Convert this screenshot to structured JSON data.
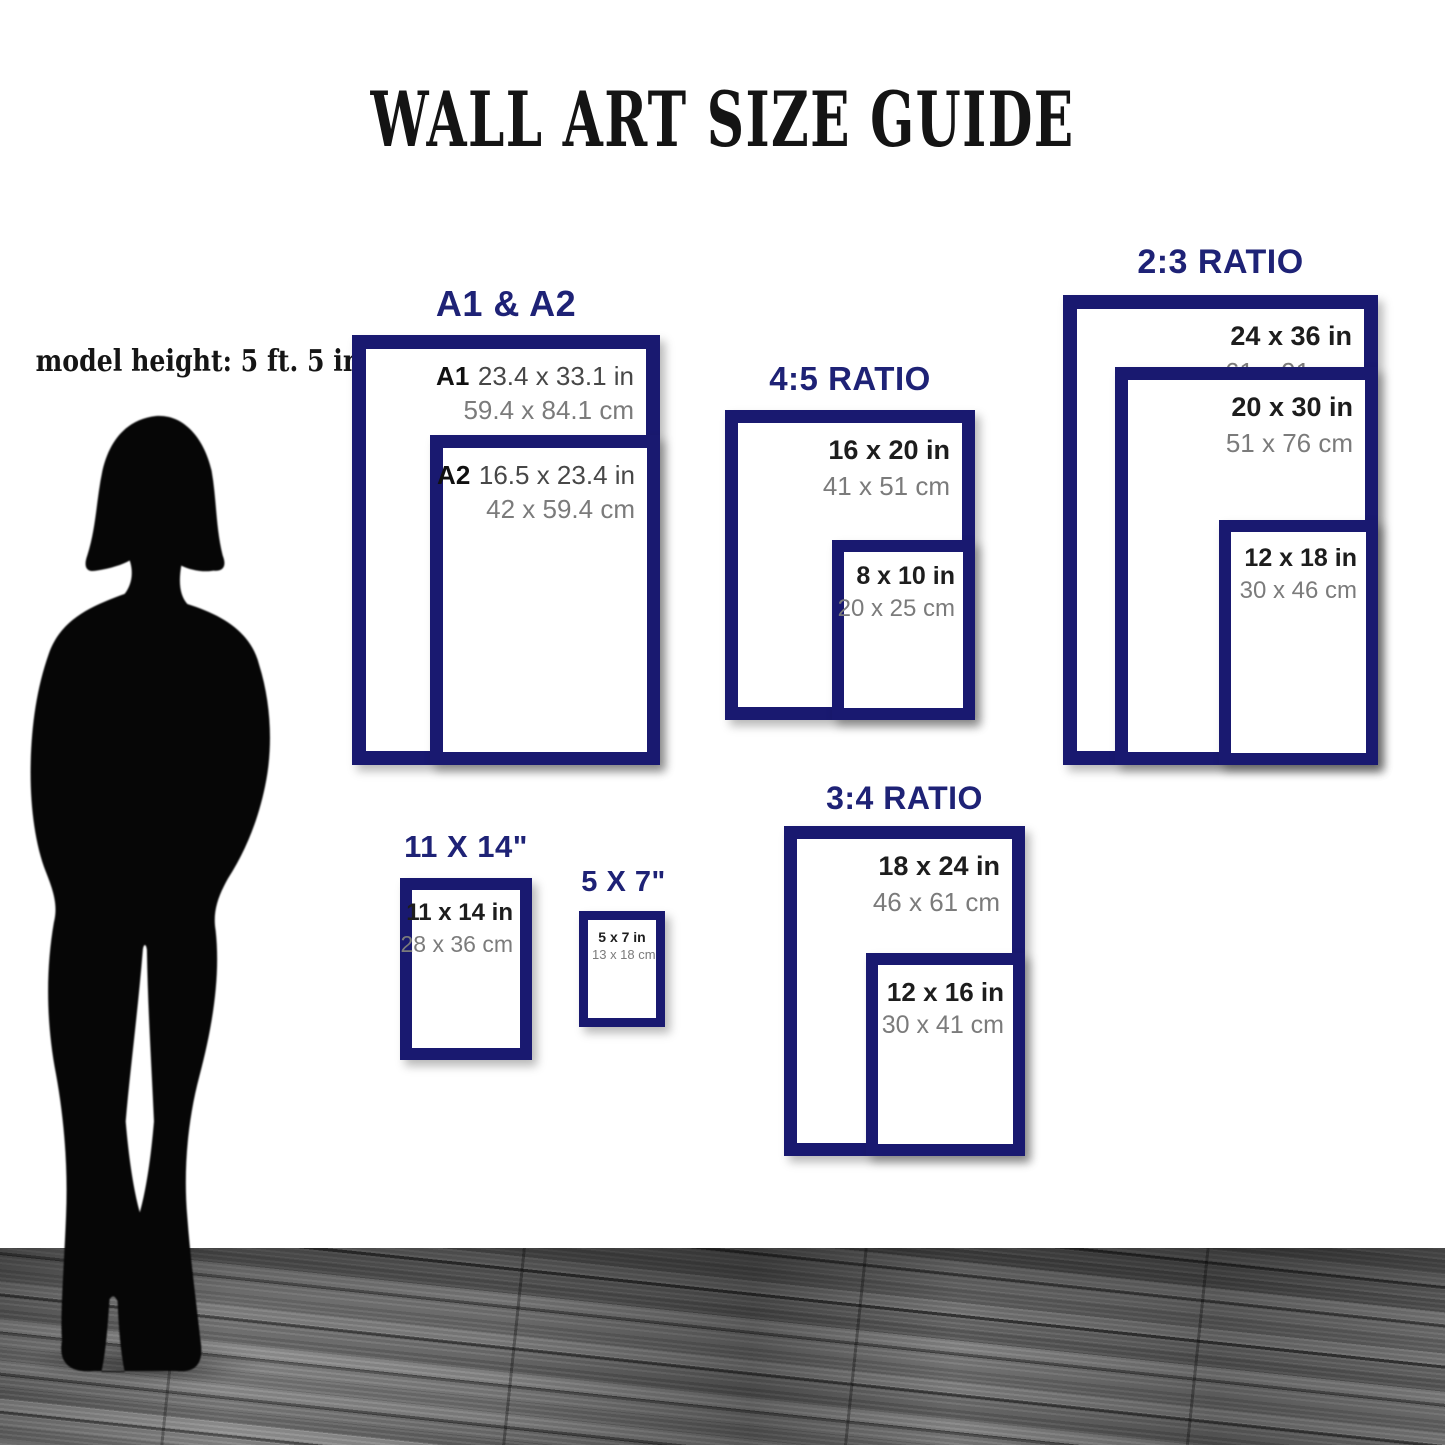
{
  "page": {
    "title": "WALL ART SIZE GUIDE",
    "model_height_label": "model height: 5 ft. 5 in"
  },
  "colors": {
    "frame_border_navy": "#191970",
    "header_navy": "#1e2276",
    "inches_text": "#1d1d1d",
    "cm_text": "#7b7b7b",
    "silhouette": "#060606",
    "background": "#ffffff"
  },
  "decor": {
    "figure": "woman-silhouette",
    "floor": "wood-floor"
  },
  "sections": [
    {
      "header": "A1 & A2",
      "frames": [
        {
          "prefix": "A1",
          "size_in": "23.4 x 33.1 in",
          "size_cm": "59.4 x 84.1 cm"
        },
        {
          "prefix": "A2",
          "size_in": "16.5 x 23.4 in",
          "size_cm": "42 x 59.4 cm"
        }
      ]
    },
    {
      "header": "4:5 RATIO",
      "frames": [
        {
          "size_in": "16 x 20 in",
          "size_cm": "41 x 51 cm"
        },
        {
          "size_in": "8 x 10 in",
          "size_cm": "20 x 25 cm"
        }
      ]
    },
    {
      "header": "2:3 RATIO",
      "frames": [
        {
          "size_in": "24 x 36 in",
          "size_cm": "61 x 91 cm"
        },
        {
          "size_in": "20 x 30 in",
          "size_cm": "51 x 76 cm"
        },
        {
          "size_in": "12 x 18 in",
          "size_cm": "30 x 46 cm"
        }
      ]
    },
    {
      "header": "11 X 14\"",
      "frames": [
        {
          "size_in": "11 x 14 in",
          "size_cm": "28 x 36 cm"
        }
      ]
    },
    {
      "header": "5 X 7\"",
      "frames": [
        {
          "size_in": "5 x 7 in",
          "size_cm": "13 x 18 cm"
        }
      ]
    },
    {
      "header": "3:4 RATIO",
      "frames": [
        {
          "size_in": "18 x 24 in",
          "size_cm": "46 x 61 cm"
        },
        {
          "size_in": "12 x 16 in",
          "size_cm": "30 x 41 cm"
        }
      ]
    }
  ]
}
